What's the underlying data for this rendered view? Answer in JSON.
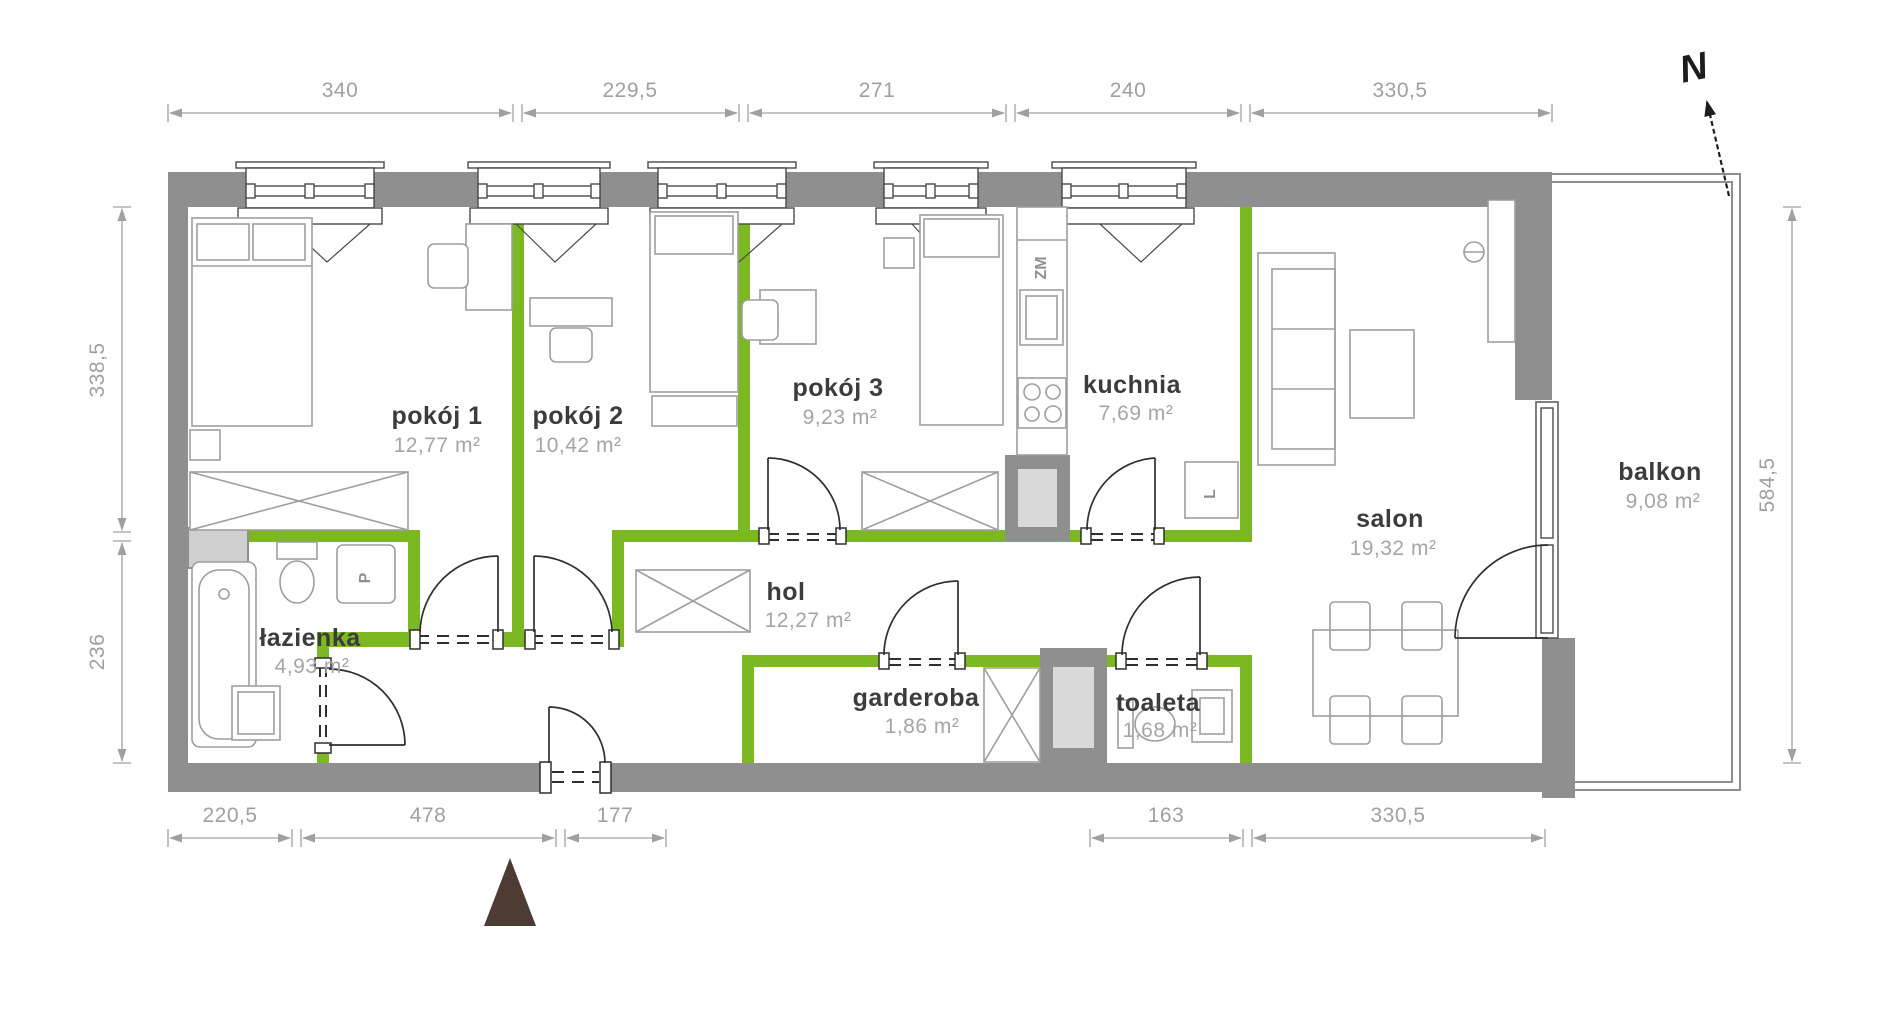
{
  "plan": {
    "north_label": "N",
    "rooms": [
      {
        "id": "pokoj-1",
        "name": "pokój 1",
        "area": "12,77 m²"
      },
      {
        "id": "pokoj-2",
        "name": "pokój 2",
        "area": "10,42 m²"
      },
      {
        "id": "pokoj-3",
        "name": "pokój 3",
        "area": "9,23 m²"
      },
      {
        "id": "kuchnia",
        "name": "kuchnia",
        "area": "7,69 m²"
      },
      {
        "id": "salon",
        "name": "salon",
        "area": "19,32 m²"
      },
      {
        "id": "hol",
        "name": "hol",
        "area": "12,27 m²"
      },
      {
        "id": "lazienka",
        "name": "łazienka",
        "area": "4,93 m²"
      },
      {
        "id": "garderoba",
        "name": "garderoba",
        "area": "1,86 m²"
      },
      {
        "id": "toaleta",
        "name": "toaleta",
        "area": "1,68 m²"
      },
      {
        "id": "balkon",
        "name": "balkon",
        "area": "9,08 m²"
      }
    ],
    "appliance_labels": {
      "dishwasher": "ZM",
      "fridge": "L",
      "washer": "P"
    },
    "dimensions": {
      "top": [
        "340",
        "229,5",
        "271",
        "240",
        "330,5"
      ],
      "bottom": [
        "220,5",
        "478",
        "177",
        "163",
        "330,5"
      ],
      "left": [
        "338,5",
        "236"
      ],
      "right": [
        "584,5"
      ]
    },
    "colors": {
      "wall_gray": "#8f8f8f",
      "wall_green": "#7cb821",
      "dim_gray": "#a0a0a0",
      "entrance_marker": "#4c3c34"
    }
  }
}
